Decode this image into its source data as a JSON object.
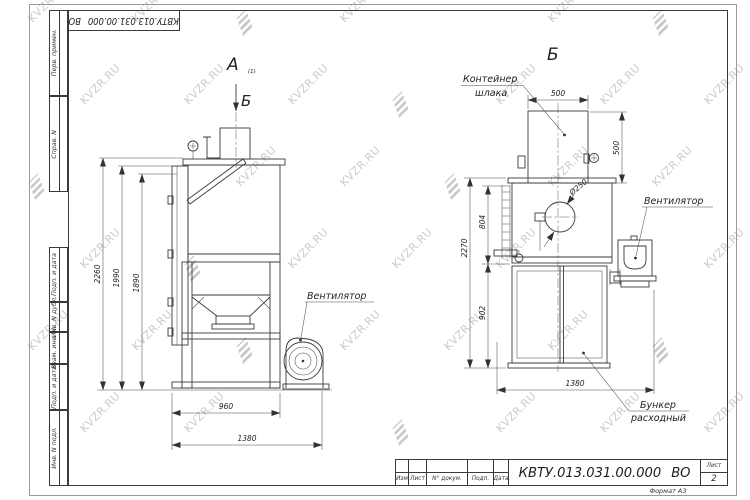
{
  "watermark": {
    "text": "KVZR.RU"
  },
  "frame": {
    "doc_number": "КВТУ.013.031.00.000 ВО",
    "sheet_label": "Лист",
    "sheet_number": "2",
    "format_label": "Формат А3",
    "revision_columns": [
      "Изм",
      "Лист",
      "N° докум.",
      "Подп.",
      "Дата"
    ],
    "side_labels": [
      "Перв. примен.",
      "Справ. N",
      "Подп. и дата",
      "Инв. N дубл.",
      "Взам. инв. N",
      "Подп. и дата",
      "Инв. N подл."
    ]
  },
  "view_a": {
    "label": "А",
    "label_sub": "(1)",
    "direction_label": "Б",
    "fan_label": "Вентилятор",
    "dim_total_height": "2260",
    "dim_height_2": "1990",
    "dim_height_3": "1890",
    "dim_width": "960",
    "dim_depth": "1380"
  },
  "view_b": {
    "label": "Б",
    "slag_container_label_line1": "Контейнер",
    "slag_container_label_line2": "шлака",
    "fan_label": "Вентилятор",
    "feed_hopper_label_line1": "Бункер",
    "feed_hopper_label_line2": "расходный",
    "dim_container_width": "500",
    "dim_container_height": "500",
    "dim_body_height": "804",
    "dim_total_height": "2270",
    "dim_frame_height": "902",
    "dim_width": "1380",
    "dim_opening_diameter": "Ø250"
  }
}
